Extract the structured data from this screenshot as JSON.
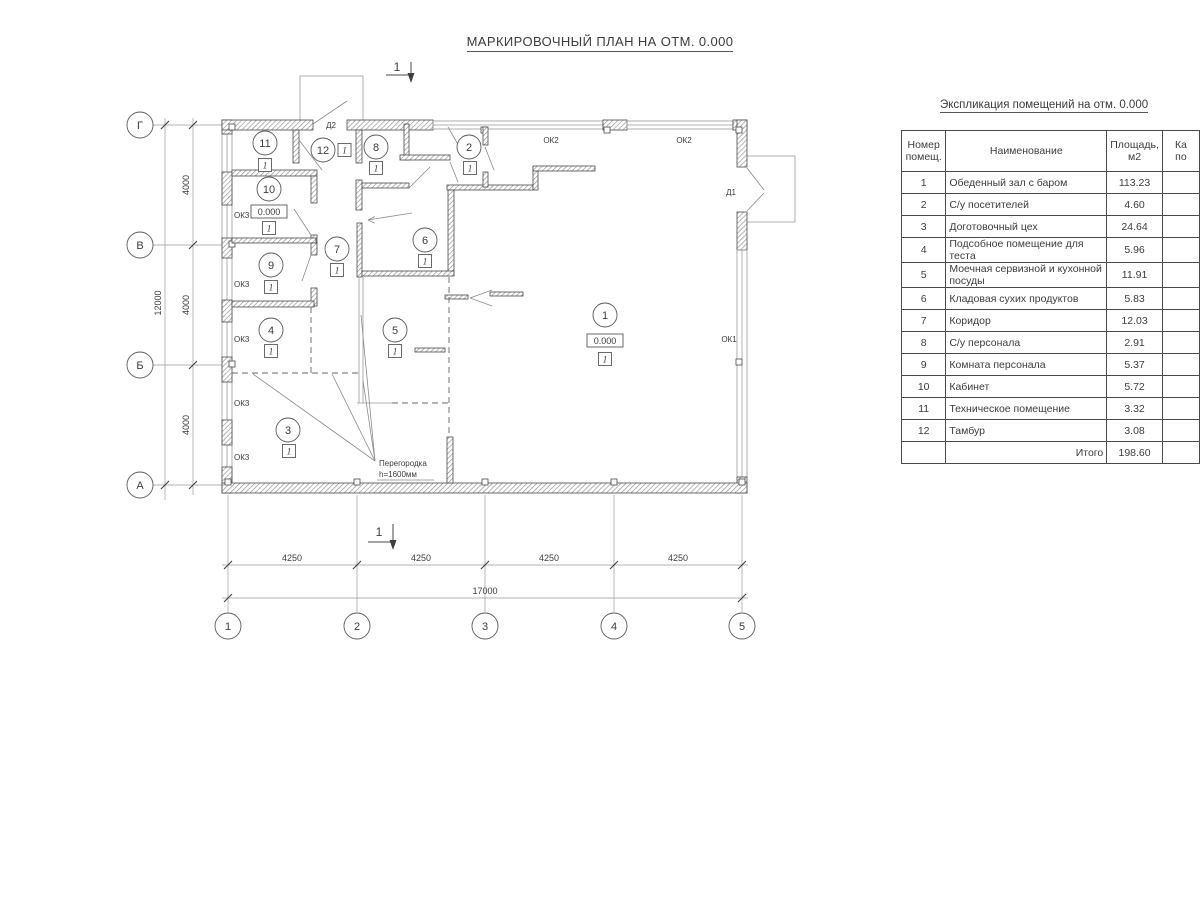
{
  "title": "МАРКИРОВОЧНЫЙ ПЛАН НА ОТМ. 0.000",
  "plan": {
    "section_mark": "1",
    "elevation": "0.000",
    "floor_mark": "1",
    "partition_note_line1": "Перегородка",
    "partition_note_line2": "h=1600мм",
    "labels": {
      "d1": "Д1",
      "d2": "Д2",
      "ok1": "ОК1",
      "ok2": "ОК2",
      "ok3": "ОК3"
    }
  },
  "grid": {
    "rows": [
      "Г",
      "В",
      "Б",
      "А"
    ],
    "cols": [
      "1",
      "2",
      "3",
      "4",
      "5"
    ]
  },
  "dims": {
    "h_segments": [
      "4250",
      "4250",
      "4250",
      "4250"
    ],
    "h_total": "17000",
    "v_segments": [
      "4000",
      "4000",
      "4000"
    ],
    "v_total": "12000"
  },
  "table": {
    "title": "Экспликация помещений на отм. 0.000",
    "headers": {
      "num": "Номер\nпомещ.",
      "name": "Наименование",
      "area": "Площадь,\nм2",
      "cut": "Ка\nпо"
    },
    "rows": [
      {
        "num": "1",
        "name": "Обеденный зал с баром",
        "area": "113.23"
      },
      {
        "num": "2",
        "name": "С/у посетителей",
        "area": "4.60"
      },
      {
        "num": "3",
        "name": "Доготовочный цех",
        "area": "24.64"
      },
      {
        "num": "4",
        "name": "Подсобное помещение для теста",
        "area": "5.96"
      },
      {
        "num": "5",
        "name": "Моечная сервизной и кухонной посуды",
        "area": "11.91"
      },
      {
        "num": "6",
        "name": "Кладовая сухих продуктов",
        "area": "5.83"
      },
      {
        "num": "7",
        "name": "Коридор",
        "area": "12.03"
      },
      {
        "num": "8",
        "name": "С/у персонала",
        "area": "2.91"
      },
      {
        "num": "9",
        "name": "Комната персонала",
        "area": "5.37"
      },
      {
        "num": "10",
        "name": "Кабинет",
        "area": "5.72"
      },
      {
        "num": "11",
        "name": "Техническое помещение",
        "area": "3.32"
      },
      {
        "num": "12",
        "name": "Тамбур",
        "area": "3.08"
      }
    ],
    "total_label": "Итого",
    "total": "198.60"
  }
}
